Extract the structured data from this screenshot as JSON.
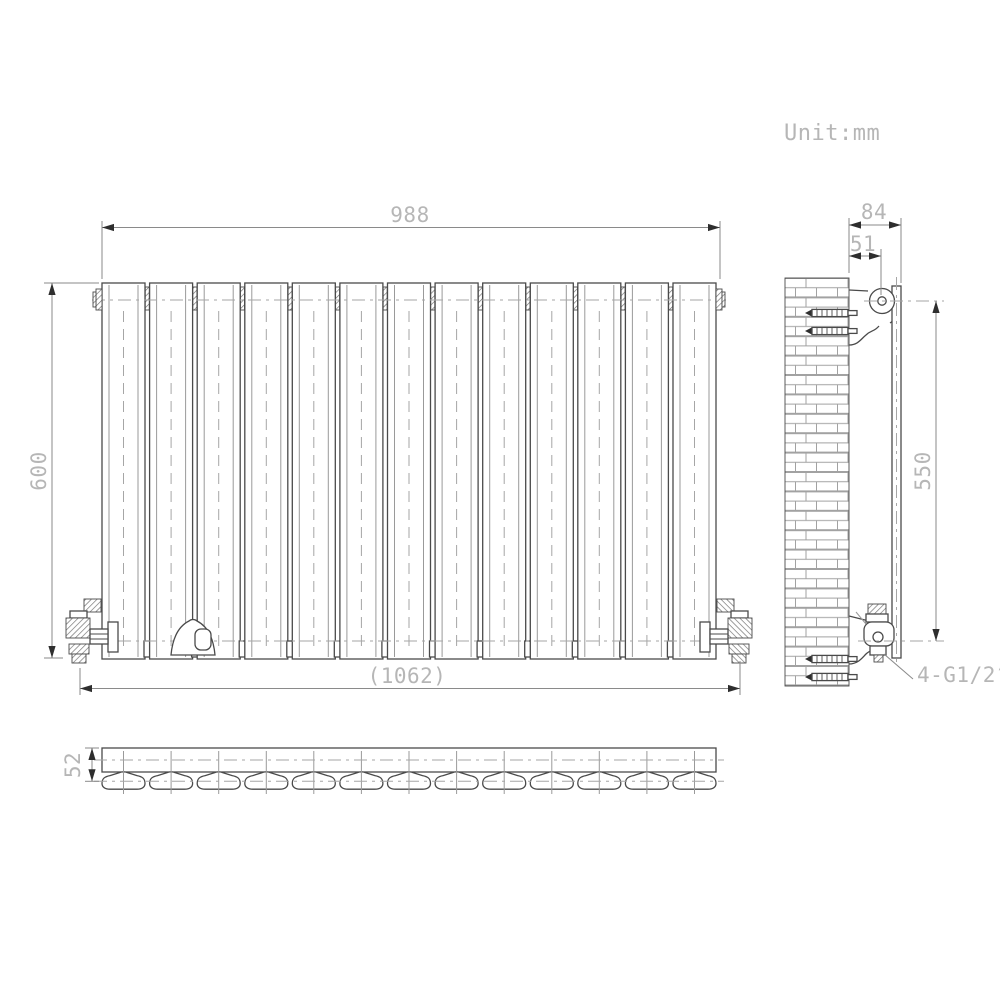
{
  "unit_note": "Unit:mm",
  "dimensions": {
    "radiator_width": "988",
    "radiator_height": "600",
    "overall_width": "(1062)",
    "wall_to_front_depth": "84",
    "wall_to_pipe_center": "51",
    "connection_vertical_spacing": "550",
    "panel_depth": "52",
    "connection_thread": "4-G1/2″"
  },
  "front_view": {
    "panel_count": 13
  },
  "bottom_view": {
    "section_count": 13
  },
  "colors": {
    "outline": "#4a4a4a",
    "thin": "#9a9a9a",
    "center": "#a6a6a6",
    "dim": "#8a8a8a",
    "arrow": "#2e2e2e",
    "text": "#b6b6b6",
    "background": "#ffffff"
  }
}
